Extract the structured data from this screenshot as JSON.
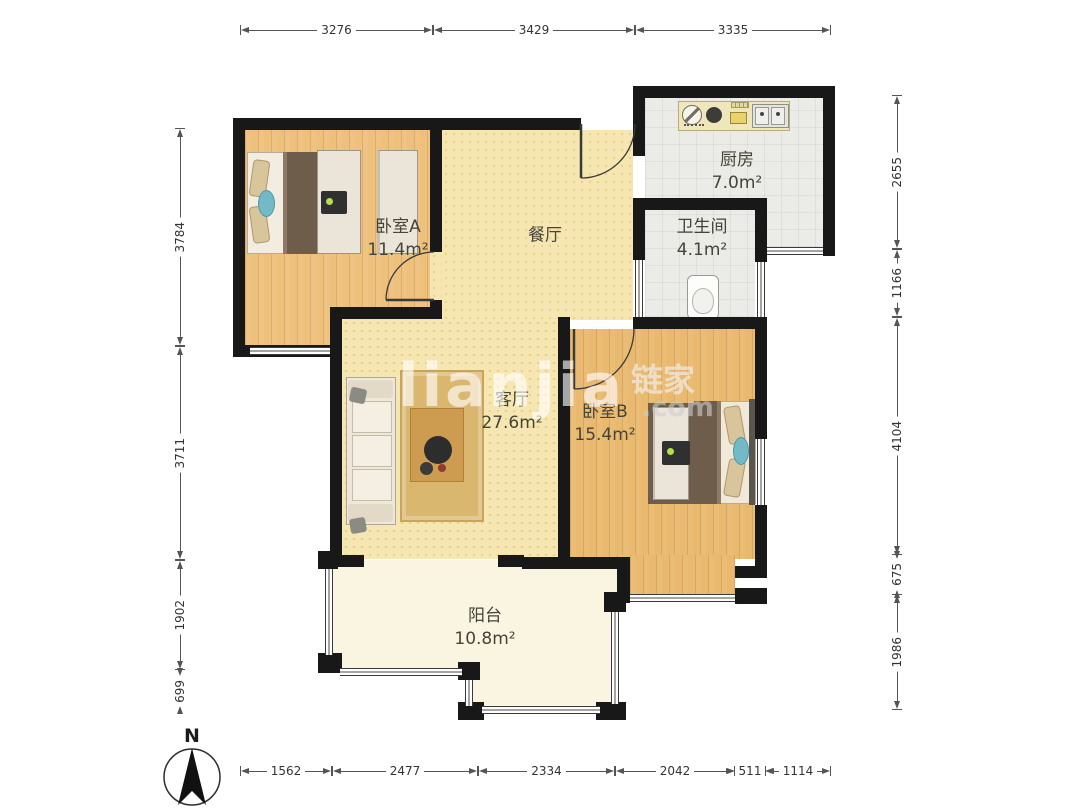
{
  "watermark": {
    "brand": "Lianjia",
    "brand_cn": "链家",
    "domain": ".com"
  },
  "compass": {
    "north_label": "N"
  },
  "rooms": [
    {
      "key": "bedroom_a",
      "name": "卧室A",
      "area": "11.4m²"
    },
    {
      "key": "dining",
      "name": "餐厅",
      "area": ""
    },
    {
      "key": "kitchen",
      "name": "厨房",
      "area": "7.0m²"
    },
    {
      "key": "bathroom",
      "name": "卫生间",
      "area": "4.1m²"
    },
    {
      "key": "living",
      "name": "客厅",
      "area": "27.6m²"
    },
    {
      "key": "bedroom_b",
      "name": "卧室B",
      "area": "15.4m²"
    },
    {
      "key": "balcony",
      "name": "阳台",
      "area": "10.8m²"
    }
  ],
  "dimensions_mm": {
    "top": [
      "3276",
      "3429",
      "3335"
    ],
    "left": [
      "3784",
      "3711",
      "1902",
      "699"
    ],
    "right": [
      "2655",
      "1166",
      "4104",
      "675",
      "1986"
    ],
    "bottom": [
      "1562",
      "2477",
      "2334",
      "2042",
      "511",
      "1114"
    ]
  },
  "colors": {
    "wall": "#181818",
    "wood_floor": "#edc07c",
    "hall_floor": "#f6e7b2",
    "tile_floor": "#ebebe7",
    "balcony_floor": "#f9f5e0",
    "accent_teal": "#74b9c6"
  }
}
